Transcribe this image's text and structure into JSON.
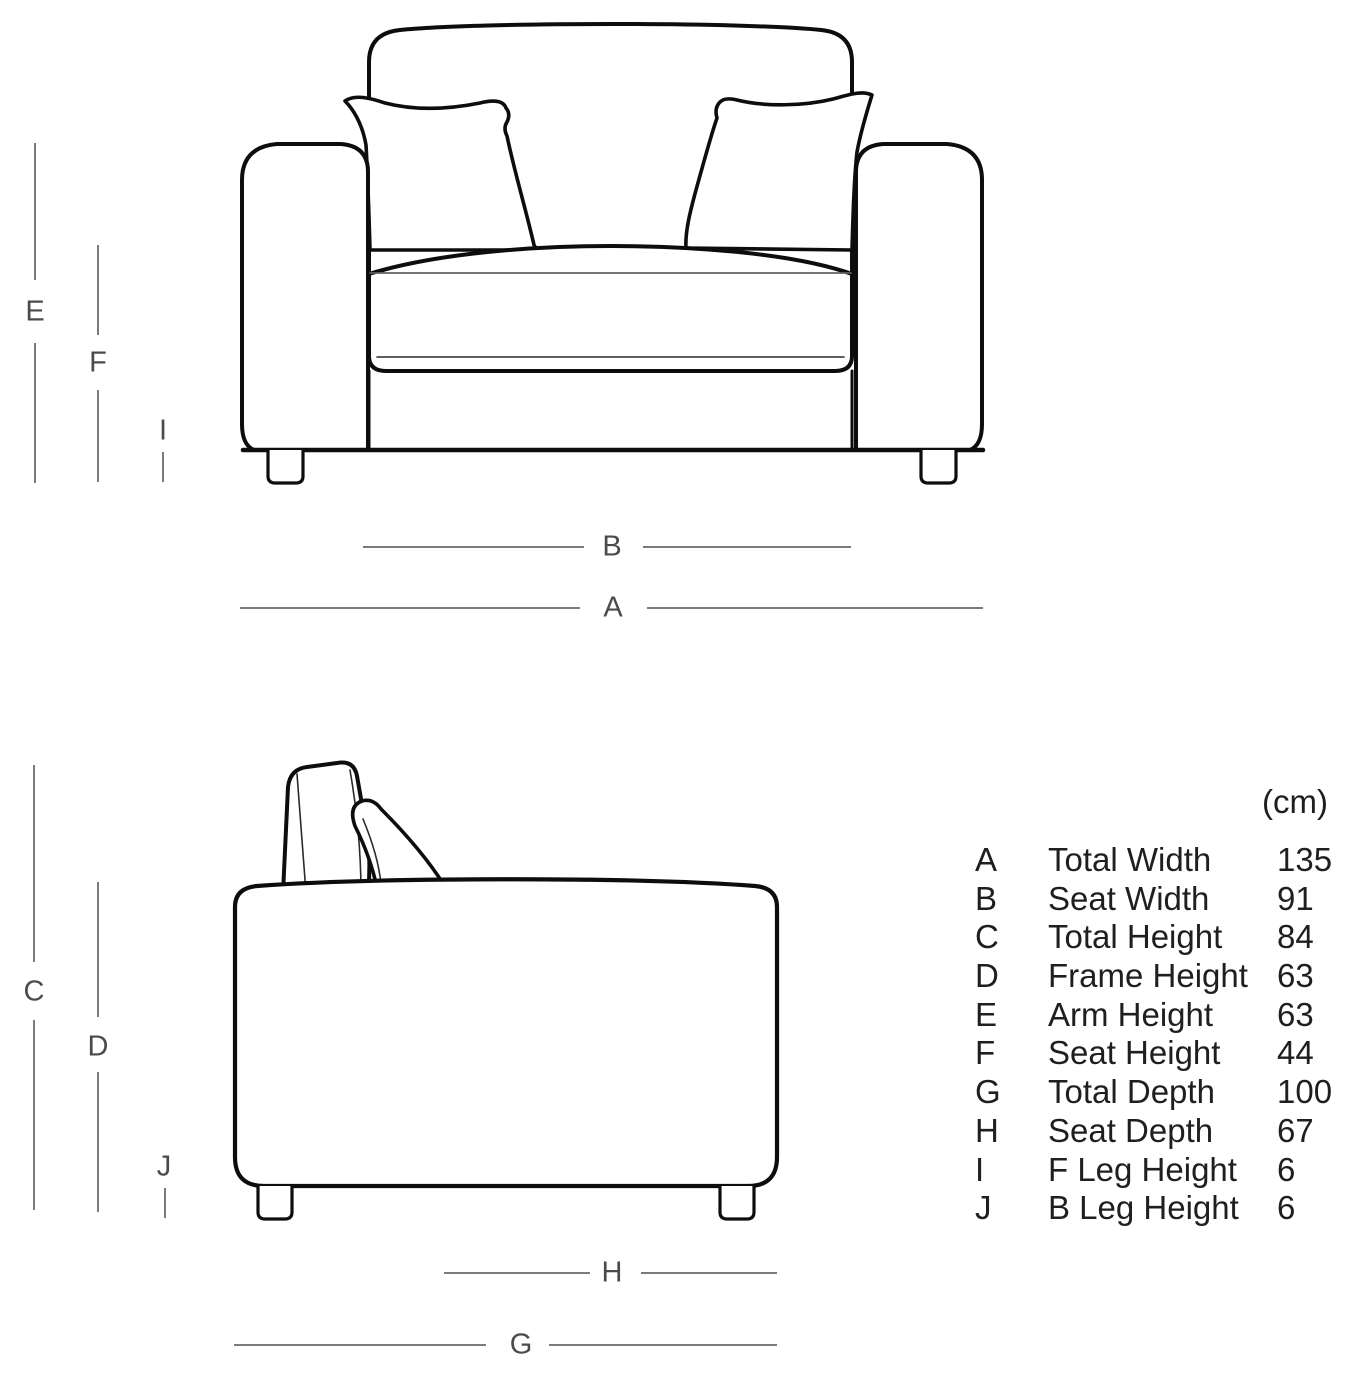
{
  "diagram": {
    "type": "furniture-dimensions",
    "views": [
      "front",
      "side"
    ]
  },
  "colors": {
    "background": "#ffffff",
    "outline": "#0d0d0d",
    "dimension_line": "#7b7b7b",
    "dimension_label": "#4b4b4b",
    "table_text": "#1f1f1f"
  },
  "front_view": {
    "labels": {
      "E": "E",
      "F": "F",
      "I": "I",
      "B": "B",
      "A": "A"
    }
  },
  "side_view": {
    "labels": {
      "C": "C",
      "D": "D",
      "J": "J",
      "H": "H",
      "G": "G"
    }
  },
  "table": {
    "unit": "(cm)",
    "rows": [
      {
        "letter": "A",
        "label": "Total Width",
        "value": "135"
      },
      {
        "letter": "B",
        "label": "Seat Width",
        "value": "91"
      },
      {
        "letter": "C",
        "label": "Total Height",
        "value": "84"
      },
      {
        "letter": "D",
        "label": "Frame Height",
        "value": "63"
      },
      {
        "letter": "E",
        "label": "Arm Height",
        "value": "63"
      },
      {
        "letter": "F",
        "label": "Seat Height",
        "value": "44"
      },
      {
        "letter": "G",
        "label": "Total Depth",
        "value": "100"
      },
      {
        "letter": "H",
        "label": "Seat Depth",
        "value": "67"
      },
      {
        "letter": "I",
        "label": "F Leg Height",
        "value": "6"
      },
      {
        "letter": "J",
        "label": "B Leg Height",
        "value": "6"
      }
    ]
  }
}
